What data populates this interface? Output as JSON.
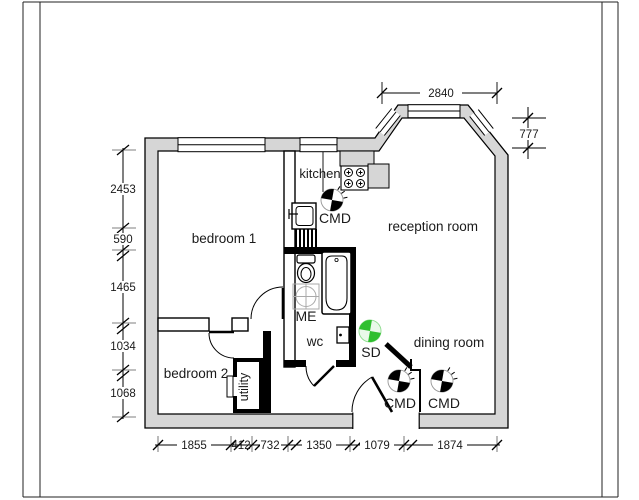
{
  "plan": {
    "rooms": {
      "bedroom1": "bedroom 1",
      "bedroom2": "bedroom 2",
      "kitchen": "kitchen",
      "reception": "reception room",
      "dining": "dining room",
      "wc": "wc",
      "utility": "utility",
      "meter": "ME"
    },
    "markers": {
      "cmd_kitchen": "CMD",
      "cmd_hall": "CMD",
      "cmd_dining": "CMD",
      "sd": "SD"
    },
    "dimensions": {
      "top": "2840",
      "bay_depth": "777",
      "left": [
        "2453",
        "590",
        "1465",
        "1034",
        "1068"
      ],
      "bottom": [
        "1855",
        "412",
        "732",
        "1350",
        "1079",
        "1874"
      ]
    },
    "colors": {
      "wall_fill": "#d6d6d6",
      "cmd_black": "#000000",
      "sd_green": "#2fbf2f"
    }
  }
}
